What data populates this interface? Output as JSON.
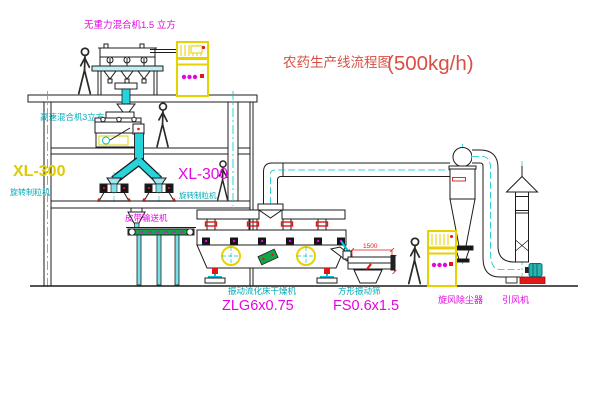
{
  "title": {
    "text": "农药生产线流程图",
    "capacity": "(500kg/h)"
  },
  "labels": {
    "gravity_free_mixer": "无重力混合机1.5 立方",
    "high_speed_mixer": "高速混合机3立方",
    "granulator_left_model": "XL-300",
    "granulator_left_name": "旋转制粒机",
    "granulator_center_model": "XL-300",
    "granulator_center_name": "旋转制粒机",
    "belt_conveyor": "皮带输送机",
    "fluid_bed_dryer_name": "振动流化床干燥机",
    "fluid_bed_dryer_model": "ZLG6x0.75",
    "vibrating_screen_name": "方形振动筛",
    "vibrating_screen_model": "FS0.6x1.5",
    "cyclone": "旋风除尘器",
    "induced_draft_fan": "引风机"
  },
  "dimensions": {
    "screen_length": "1500"
  },
  "colors": {
    "magenta": "#e206e2",
    "cyan_text": "#00aab6",
    "cyan_line": "#00c5ce",
    "yellow": "#e6d200",
    "title_red": "#d94f43",
    "accent_red": "#e01818",
    "green": "#16a34a",
    "line": "#1c1c1c"
  }
}
